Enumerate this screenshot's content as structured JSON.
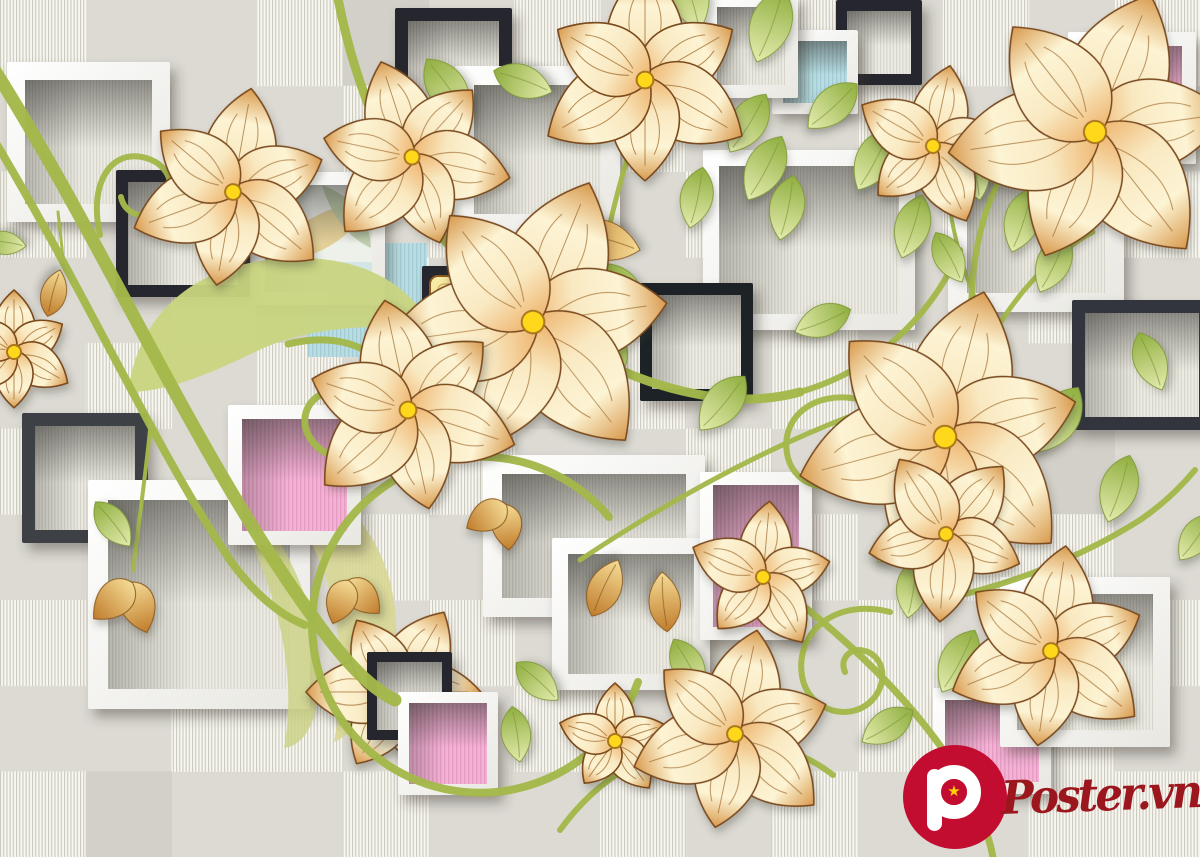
{
  "canvas": {
    "width": 1200,
    "height": 857
  },
  "palette": {
    "bg_plain": "#dcdad3",
    "bg_plain_dark": "#d2d0c8",
    "bg_stripe_base": "#f7f6f0",
    "bg_stripe_line": "#ccc9bd",
    "win_base": "#ecebe3",
    "win_line": "#d6d3c8",
    "frame_white": "#ffffff",
    "frame_white_shade": "#e8e7e1",
    "frame_black": "#26282d",
    "frame_charcoal": "#3d4045",
    "pink": "#f3b3d5",
    "pink_line": "#e79cc4",
    "blue": "#b9dde2",
    "blue_line": "#a3ccd4",
    "gold_light": "#f9efab",
    "gold_dark": "#edbf55",
    "petal_base": "#eeb36b",
    "petal_mid": "#f9e9c2",
    "petal_light": "#fdf4d4",
    "petal_tip": "#d89a4e",
    "petal_outline": "#7a4a1e",
    "petal_vein": "#a06a28",
    "flower_center": "#ffd81c",
    "flower_center_ring": "#a9771b",
    "leaf_base": "#e4ecae",
    "leaf_tip": "#8fae3f",
    "leaf_vein": "#7f9838",
    "vine": "#a3b84a",
    "big_leaf_1": "#c9d57f",
    "big_leaf_2": "#d8d794",
    "big_leaf_3": "#cdd287",
    "w2_leaf_gold": "#e3d098",
    "w2_leaf_green": "#b9c9a4",
    "w2_blue": "#cfe3e4",
    "logo_red": "#c20d31",
    "logo_text_red": "#9c161d",
    "star_yellow": "#ffd400"
  },
  "tile_map": [
    [
      1,
      0,
      0,
      1,
      2,
      0,
      1,
      0,
      1,
      1,
      0,
      1,
      0,
      1
    ],
    [
      0,
      2,
      0,
      0,
      1,
      0,
      0,
      1,
      0,
      0,
      1,
      0,
      1,
      0
    ],
    [
      1,
      0,
      1,
      0,
      0,
      1,
      0,
      0,
      1,
      2,
      0,
      1,
      0,
      1
    ],
    [
      0,
      0,
      1,
      2,
      1,
      0,
      1,
      0,
      0,
      1,
      0,
      0,
      1,
      0
    ],
    [
      0,
      1,
      0,
      1,
      0,
      0,
      2,
      1,
      0,
      1,
      1,
      0,
      0,
      1
    ],
    [
      1,
      0,
      0,
      1,
      0,
      1,
      0,
      0,
      1,
      0,
      0,
      1,
      2,
      0
    ],
    [
      0,
      1,
      2,
      0,
      1,
      0,
      1,
      0,
      0,
      1,
      0,
      1,
      1,
      0
    ],
    [
      1,
      0,
      1,
      0,
      0,
      1,
      0,
      1,
      2,
      0,
      1,
      0,
      0,
      1
    ],
    [
      0,
      0,
      1,
      1,
      0,
      0,
      1,
      0,
      1,
      0,
      1,
      2,
      1,
      0
    ],
    [
      1,
      2,
      0,
      0,
      1,
      0,
      0,
      1,
      0,
      1,
      0,
      0,
      1,
      1
    ]
  ],
  "scene": [
    {
      "t": "wf",
      "x": 7,
      "y": 62,
      "w": 163,
      "h": 160,
      "b": 18
    },
    {
      "t": "bf",
      "x": 395,
      "y": 8,
      "w": 117,
      "h": 110,
      "b": 13,
      "c": "#26282d"
    },
    {
      "t": "wf",
      "x": 455,
      "y": 66,
      "w": 165,
      "h": 167,
      "b": 19
    },
    {
      "t": "bf",
      "x": 836,
      "y": 0,
      "w": 86,
      "h": 85,
      "b": 11,
      "c": "#26282d"
    },
    {
      "t": "wf",
      "x": 772,
      "y": 30,
      "w": 86,
      "h": 84,
      "b": 11,
      "win": "blue"
    },
    {
      "t": "wf",
      "x": 704,
      "y": -6,
      "w": 94,
      "h": 104,
      "b": 13
    },
    {
      "t": "wf",
      "x": 703,
      "y": 150,
      "w": 212,
      "h": 180,
      "b": 16
    },
    {
      "t": "wf",
      "x": 948,
      "y": 137,
      "w": 176,
      "h": 175,
      "b": 19
    },
    {
      "t": "bf",
      "x": 640,
      "y": 283,
      "w": 113,
      "h": 118,
      "b": 12,
      "c": "#1f2126"
    },
    {
      "t": "bf",
      "x": 1072,
      "y": 300,
      "w": 140,
      "h": 130,
      "b": 13,
      "c": "#33363c"
    },
    {
      "t": "sq",
      "x": 308,
      "y": 243,
      "w": 119,
      "h": 114,
      "p": "blue"
    },
    {
      "t": "wf",
      "x": 252,
      "y": 172,
      "w": 133,
      "h": 133,
      "b": 13,
      "win": "w2"
    },
    {
      "t": "bf",
      "x": 116,
      "y": 170,
      "w": 134,
      "h": 127,
      "b": 12,
      "c": "#26282d"
    },
    {
      "t": "bf",
      "x": 22,
      "y": 413,
      "w": 126,
      "h": 130,
      "b": 13,
      "c": "#3d4045"
    },
    {
      "t": "path",
      "d": "M 128 392 C 140 305, 205 258, 300 258 C 370 258, 415 290, 432 330 C 360 322, 300 330, 255 352 C 205 376, 165 392, 128 392 Z",
      "f": "#c9d57f",
      "o": 0.95
    },
    {
      "t": "wf",
      "x": 483,
      "y": 455,
      "w": 222,
      "h": 162,
      "b": 19
    },
    {
      "t": "wf",
      "x": 88,
      "y": 480,
      "w": 222,
      "h": 229,
      "b": 20
    },
    {
      "t": "wf",
      "x": 552,
      "y": 538,
      "w": 158,
      "h": 152,
      "b": 16
    },
    {
      "t": "path",
      "d": "M 252 462 C 332 472, 392 532, 396 622 C 398 684, 372 724, 334 742 C 352 642, 334 540, 252 462 Z",
      "f": "#d8d794",
      "o": 0.9
    },
    {
      "t": "path",
      "d": "M 212 470 C 282 522, 322 602, 318 690 C 316 730, 300 746, 284 748 C 300 660, 270 560, 212 470 Z",
      "f": "#cdd287",
      "o": 0.85
    },
    {
      "t": "bf",
      "x": 422,
      "y": 266,
      "w": 108,
      "h": 90,
      "b": 11,
      "c": "#26282d"
    },
    {
      "t": "gold",
      "x": 430,
      "y": 276,
      "w": 76,
      "h": 74
    },
    {
      "t": "flower",
      "x": 398,
      "y": 692,
      "r": 92,
      "n": 6,
      "rot": 30
    },
    {
      "t": "bf",
      "x": 367,
      "y": 652,
      "w": 85,
      "h": 88,
      "b": 10,
      "c": "#26282d"
    },
    {
      "t": "wf",
      "x": 398,
      "y": 692,
      "w": 100,
      "h": 103,
      "b": 11,
      "win": "pink"
    },
    {
      "t": "wf",
      "x": 228,
      "y": 405,
      "w": 133,
      "h": 140,
      "b": 14,
      "win": "pink"
    },
    {
      "t": "wf",
      "x": 700,
      "y": 472,
      "w": 112,
      "h": 168,
      "b": 13,
      "win": "pink"
    },
    {
      "t": "wf",
      "x": 1068,
      "y": 32,
      "w": 128,
      "h": 132,
      "b": 14,
      "win": "pink"
    },
    {
      "t": "wf",
      "x": 933,
      "y": 688,
      "w": 118,
      "h": 106,
      "b": 12,
      "win": "pink"
    },
    {
      "t": "wf",
      "x": 1000,
      "y": 577,
      "w": 170,
      "h": 170,
      "b": 17
    },
    {
      "t": "vine",
      "d": "M -15 55 C 110 250, 200 470, 330 640 C 355 672, 375 690, 395 700",
      "w": 13
    },
    {
      "t": "vine",
      "d": "M -15 125 C 80 280, 150 440, 230 560 C 255 595, 280 615, 305 625",
      "w": 8
    },
    {
      "t": "vine",
      "d": "M 336 -12 C 358 110, 415 240, 530 320 C 640 395, 735 410, 800 392",
      "w": 9
    },
    {
      "t": "vine",
      "d": "M 800 392 C 870 372, 930 320, 960 250",
      "w": 6
    },
    {
      "t": "vine",
      "d": "M 580 560 C 700 480, 820 420, 930 390",
      "w": 5
    },
    {
      "t": "vine",
      "d": "M 990 470 C 975 400, 965 330, 975 260 C 980 225, 990 195, 1005 170",
      "w": 6
    },
    {
      "t": "vine",
      "d": "M 985 350 C 1010 300, 1050 255, 1093 232",
      "w": 5
    },
    {
      "t": "vine",
      "d": "M 978 305 C 960 265, 950 220, 946 180",
      "w": 4
    },
    {
      "t": "vine",
      "d": "M 770 580 C 850 640, 910 700, 950 760 C 975 800, 988 830, 993 857",
      "w": 7
    },
    {
      "t": "vine",
      "d": "M 560 830 C 600 775, 650 748, 712 742 C 765 738, 805 753, 833 775",
      "w": 6
    },
    {
      "t": "vine",
      "d": "M 648 95 C 625 160, 602 240, 594 318",
      "w": 5
    },
    {
      "t": "vine",
      "d": "M 940 600 C 1010 585, 1080 558, 1140 520 C 1162 505, 1180 488, 1195 470",
      "w": 6
    },
    {
      "t": "vine",
      "d": "M 150 430 C 145 480, 138 528, 133 570",
      "w": 4
    },
    {
      "t": "vine",
      "d": "M 58 212 C 60 230, 62 246, 63 260",
      "w": 3
    },
    {
      "t": "vine",
      "d": "M 100 235 C 88 182, 112 148, 146 158 C 174 166, 178 196, 158 210 C 142 221, 124 213, 121 197",
      "w": 6
    },
    {
      "t": "vine",
      "d": "M 288 344 C 352 328, 402 360, 398 412 C 395 454, 350 472, 320 449 C 298 432, 301 404, 322 394",
      "w": 7
    },
    {
      "t": "vine",
      "d": "M 609 517 A 168 168 0 1 0 638 682",
      "w": 8
    },
    {
      "t": "vine",
      "d": "M 862 400 C 812 388, 778 420, 788 458 C 796 488, 834 496, 852 474 C 866 456, 858 432, 838 430",
      "w": 6
    },
    {
      "t": "vine",
      "d": "M 890 612 C 835 598, 795 632, 802 676 C 808 712, 852 724, 874 698 C 890 678, 882 652, 860 650 C 847 650, 840 661, 845 672",
      "w": 6
    },
    {
      "t": "leaf",
      "x": 468,
      "y": 118,
      "rot": -35,
      "len": 72
    },
    {
      "t": "leaf",
      "x": 552,
      "y": 92,
      "rot": -70,
      "len": 62
    },
    {
      "t": "leaf",
      "x": 700,
      "y": 30,
      "rot": -18,
      "len": 78
    },
    {
      "t": "leaf",
      "x": 730,
      "y": 152,
      "rot": 32,
      "len": 68
    },
    {
      "t": "leaf",
      "x": 690,
      "y": 228,
      "rot": 12,
      "len": 62
    },
    {
      "t": "leaf",
      "x": 748,
      "y": 200,
      "rot": 28,
      "len": 72
    },
    {
      "t": "leaf",
      "x": 780,
      "y": 240,
      "rot": 12,
      "len": 66
    },
    {
      "t": "leaf",
      "x": 757,
      "y": 62,
      "rot": 20,
      "len": 78
    },
    {
      "t": "leaf",
      "x": 808,
      "y": 128,
      "rot": 48,
      "len": 66
    },
    {
      "t": "leaf",
      "x": 858,
      "y": 190,
      "rot": 28,
      "len": 70
    },
    {
      "t": "leaf",
      "x": 902,
      "y": 258,
      "rot": 18,
      "len": 66
    },
    {
      "t": "leaf",
      "x": 795,
      "y": 332,
      "rot": 68,
      "len": 60
    },
    {
      "t": "leaf",
      "x": 980,
      "y": 200,
      "rot": -12,
      "len": 60
    },
    {
      "t": "leaf",
      "x": 1012,
      "y": 252,
      "rot": 18,
      "len": 68
    },
    {
      "t": "leaf",
      "x": 962,
      "y": 282,
      "rot": -28,
      "len": 56
    },
    {
      "t": "leaf",
      "x": 1040,
      "y": 292,
      "rot": 25,
      "len": 64
    },
    {
      "t": "leaf",
      "x": 982,
      "y": 392,
      "rot": 12,
      "len": 70
    },
    {
      "t": "leaf",
      "x": 1038,
      "y": 452,
      "rot": 32,
      "len": 76
    },
    {
      "t": "leaf",
      "x": 1108,
      "y": 522,
      "rot": 18,
      "len": 70
    },
    {
      "t": "leaf",
      "x": 1162,
      "y": 390,
      "rot": -22,
      "len": 62
    },
    {
      "t": "leaf",
      "x": 1180,
      "y": 560,
      "rot": 35,
      "len": 56
    },
    {
      "t": "leaf",
      "x": 640,
      "y": 320,
      "rot": -30,
      "len": 65
    },
    {
      "t": "leaf",
      "x": 600,
      "y": 390,
      "rot": 20,
      "len": 60
    },
    {
      "t": "leaf",
      "x": 700,
      "y": 430,
      "rot": 40,
      "len": 70
    },
    {
      "t": "leaf",
      "x": 870,
      "y": 440,
      "rot": 35,
      "len": 65
    },
    {
      "t": "leaf",
      "x": 915,
      "y": 470,
      "rot": 10,
      "len": 60
    },
    {
      "t": "leaf",
      "x": 878,
      "y": 562,
      "rot": 42,
      "len": 64
    },
    {
      "t": "leaf",
      "x": 908,
      "y": 618,
      "rot": 8,
      "len": 60
    },
    {
      "t": "leaf",
      "x": 942,
      "y": 692,
      "rot": 28,
      "len": 70
    },
    {
      "t": "leaf",
      "x": 862,
      "y": 742,
      "rot": 58,
      "len": 60
    },
    {
      "t": "leaf",
      "x": 702,
      "y": 692,
      "rot": -28,
      "len": 60
    },
    {
      "t": "leaf",
      "x": 643,
      "y": 782,
      "rot": 8,
      "len": 60
    },
    {
      "t": "leaf",
      "x": 558,
      "y": 700,
      "rot": -48,
      "len": 56
    },
    {
      "t": "leaf",
      "x": 520,
      "y": 762,
      "rot": -8,
      "len": 56
    },
    {
      "t": "leaf",
      "x": 130,
      "y": 546,
      "rot": -38,
      "len": 56
    },
    {
      "t": "leaf",
      "x": 26,
      "y": 246,
      "rot": -82,
      "len": 44
    },
    {
      "t": "leaf",
      "x": 618,
      "y": 560,
      "rot": 205,
      "len": 62,
      "style": "gold"
    },
    {
      "t": "leaf",
      "x": 662,
      "y": 572,
      "rot": 175,
      "len": 60,
      "style": "gold"
    },
    {
      "t": "leaf",
      "x": 640,
      "y": 250,
      "rot": -75,
      "len": 75,
      "style": "gold"
    },
    {
      "t": "leaf",
      "x": 60,
      "y": 270,
      "rot": 195,
      "len": 48,
      "style": "gold"
    },
    {
      "t": "bud",
      "x": 131,
      "y": 584,
      "rot": 12,
      "s": 30
    },
    {
      "t": "bud",
      "x": 348,
      "y": 582,
      "rot": -15,
      "s": 26
    },
    {
      "t": "bud",
      "x": 505,
      "y": 506,
      "rot": 25,
      "s": 26
    },
    {
      "t": "flower",
      "x": 233,
      "y": 192,
      "r": 105,
      "n": 6,
      "rot": 10
    },
    {
      "t": "flower",
      "x": 412,
      "y": 157,
      "r": 100,
      "n": 6,
      "rot": -18
    },
    {
      "t": "flower",
      "x": 645,
      "y": 80,
      "r": 112,
      "n": 6,
      "rot": 0
    },
    {
      "t": "flower",
      "x": 933,
      "y": 146,
      "r": 82,
      "n": 5,
      "rot": 12
    },
    {
      "t": "flower",
      "x": 1095,
      "y": 132,
      "r": 148,
      "n": 6,
      "rot": 22
    },
    {
      "t": "flower",
      "x": 14,
      "y": 352,
      "r": 62,
      "n": 6,
      "rot": 0
    },
    {
      "t": "flower",
      "x": 533,
      "y": 322,
      "r": 150,
      "n": 6,
      "rot": 22
    },
    {
      "t": "flower",
      "x": 408,
      "y": 410,
      "r": 112,
      "n": 6,
      "rot": -12
    },
    {
      "t": "flower",
      "x": 945,
      "y": 437,
      "r": 150,
      "n": 6,
      "rot": 15
    },
    {
      "t": "flower",
      "x": 946,
      "y": 534,
      "r": 88,
      "n": 5,
      "rot": 40
    },
    {
      "t": "flower",
      "x": 763,
      "y": 577,
      "r": 76,
      "n": 5,
      "rot": 5
    },
    {
      "t": "flower",
      "x": 615,
      "y": 741,
      "r": 58,
      "n": 5,
      "rot": 0
    },
    {
      "t": "flower",
      "x": 735,
      "y": 734,
      "r": 106,
      "n": 6,
      "rot": 12
    },
    {
      "t": "flower",
      "x": 1051,
      "y": 651,
      "r": 106,
      "n": 6,
      "rot": 8
    }
  ],
  "logo": {
    "letter": "P",
    "star": "★",
    "text": "Poster.vn"
  }
}
